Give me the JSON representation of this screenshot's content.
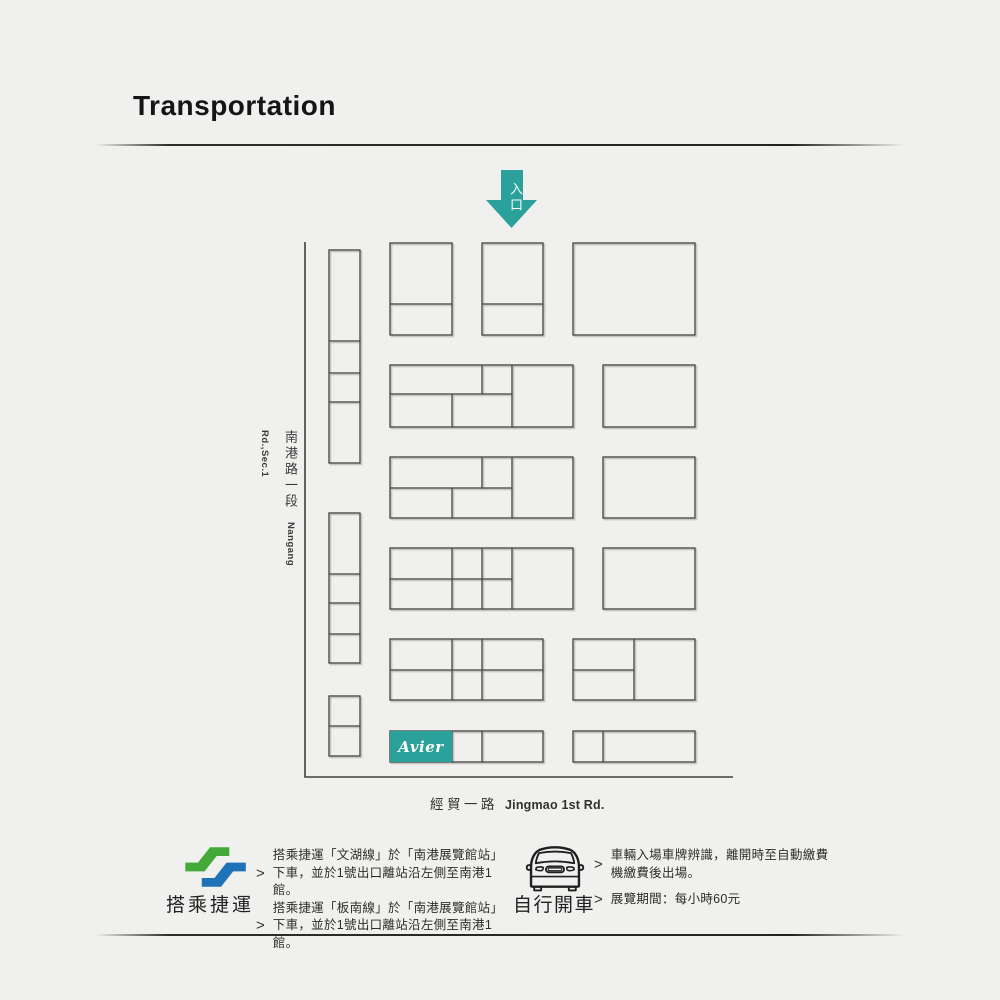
{
  "header": {
    "title": "Transportation"
  },
  "colors": {
    "accent": "#2aa19b",
    "metro_green": "#43a938",
    "metro_blue": "#1e72b8",
    "line": "#41403c"
  },
  "map": {
    "entrance_label": "入口",
    "left_road_zh": "南港路一段",
    "left_road_en": "Nangang Rd.,Sec.1",
    "bottom_road_zh": "經貿一路",
    "bottom_road_en": "Jingmao 1st Rd.",
    "booth_brand": "Avier"
  },
  "legend": {
    "mrt": {
      "label": "搭乘捷運",
      "bullets": [
        {
          "marker": ">",
          "text": "搭乘捷運「文湖線」於「南港展覽館站」下車，並於1號出口離站沿左側至南港1館。"
        },
        {
          "marker": ">",
          "text": "搭乘捷運「板南線」於「南港展覽館站」下車，並於1號出口離站沿左側至南港1館。"
        }
      ]
    },
    "car": {
      "label": "自行開車",
      "bullets": [
        {
          "marker": ">",
          "text": "車輛入場車牌辨識，離開時至自動繳費機繳費後出場。"
        },
        {
          "marker": ">",
          "text": "展覽期間：每小時60元"
        }
      ]
    }
  }
}
